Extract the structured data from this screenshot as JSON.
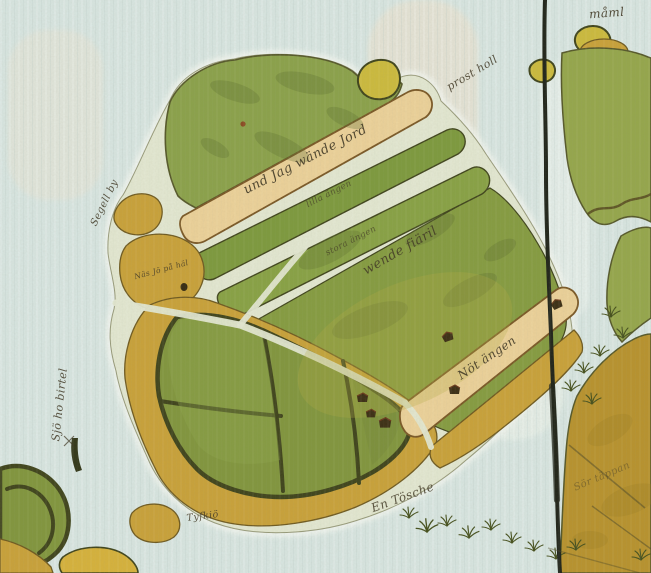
{
  "map": {
    "title": "Hand-drawn historical map — island with strip fields and enclosures",
    "description": "Old painted cadastral-style map: central island with green meadow strips, tan ploughed strips, dark-hedged enclosures, ochre shores, small islets, a winding river to the east and a dark near-vertical boundary ink line.",
    "labels": {
      "top_right": "måml",
      "top_center_water": "prost holl",
      "upper_tan_strip": "und Jag wände Jord",
      "green_strip_1": "lilla ängen",
      "green_strip_2": "stora ängen",
      "central_field": "wende fiäril",
      "lower_tan_strip": "Nöt ängen",
      "west_hummock": "Näs Jö på häl",
      "west_coast": "Segell by",
      "left_water_vertical": "Sjö ho birtel",
      "bottom_water": "En Tösche",
      "small_islet": "Tyfkiö",
      "bottom_right_faint": "Sör täppan"
    },
    "symbols": {
      "building_marks": 6,
      "grass_tufts": 16,
      "islets": 5,
      "boundary_line": "dark ink line, near-vertical, top edge to bottom edge"
    },
    "colors": {
      "water": "#d8e6e2",
      "channel": "#e3e8d2",
      "meadow": "#8ba24b",
      "strip_green_dark": "#7d9a3e",
      "strip_green": "#88a245",
      "field_green": "#859c41",
      "enclosure_green": "#81963e",
      "tan": "#ecd29a",
      "tan_outline": "#7a5826",
      "ochre": "#c9a23a",
      "ochre_outline": "#6f5a20",
      "ochre_dark": "#b8932e",
      "sand_yellow": "#d6b23c",
      "islet_yellow": "#ccbb3e",
      "mainland_green": "#95a74c",
      "outline": "#55582a",
      "outline_dark": "#3f441c",
      "ink": "#3f3724",
      "boundary": "#20241a"
    }
  }
}
